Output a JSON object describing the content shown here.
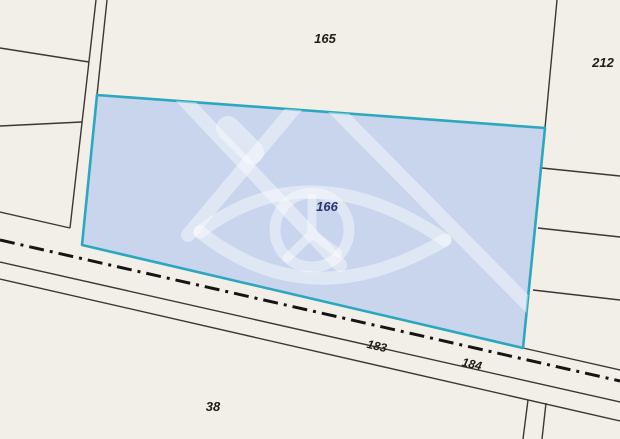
{
  "map": {
    "type": "cadastral-parcel-map",
    "background_color": "#f2efe9",
    "boundary_line_color": "#3a3833",
    "road_centerline_color": "#161513",
    "selected_parcel": {
      "number": "166",
      "fill_color": "#c9d4ed",
      "outline_color": "#2ba8bd",
      "number_color": "#2a336d"
    },
    "parcel_numbers": {
      "top": "165",
      "top_right": "212",
      "road_left": "183",
      "road_right": "184",
      "bottom_left": "38"
    },
    "watermark_icon": "cadastre-emblem"
  }
}
